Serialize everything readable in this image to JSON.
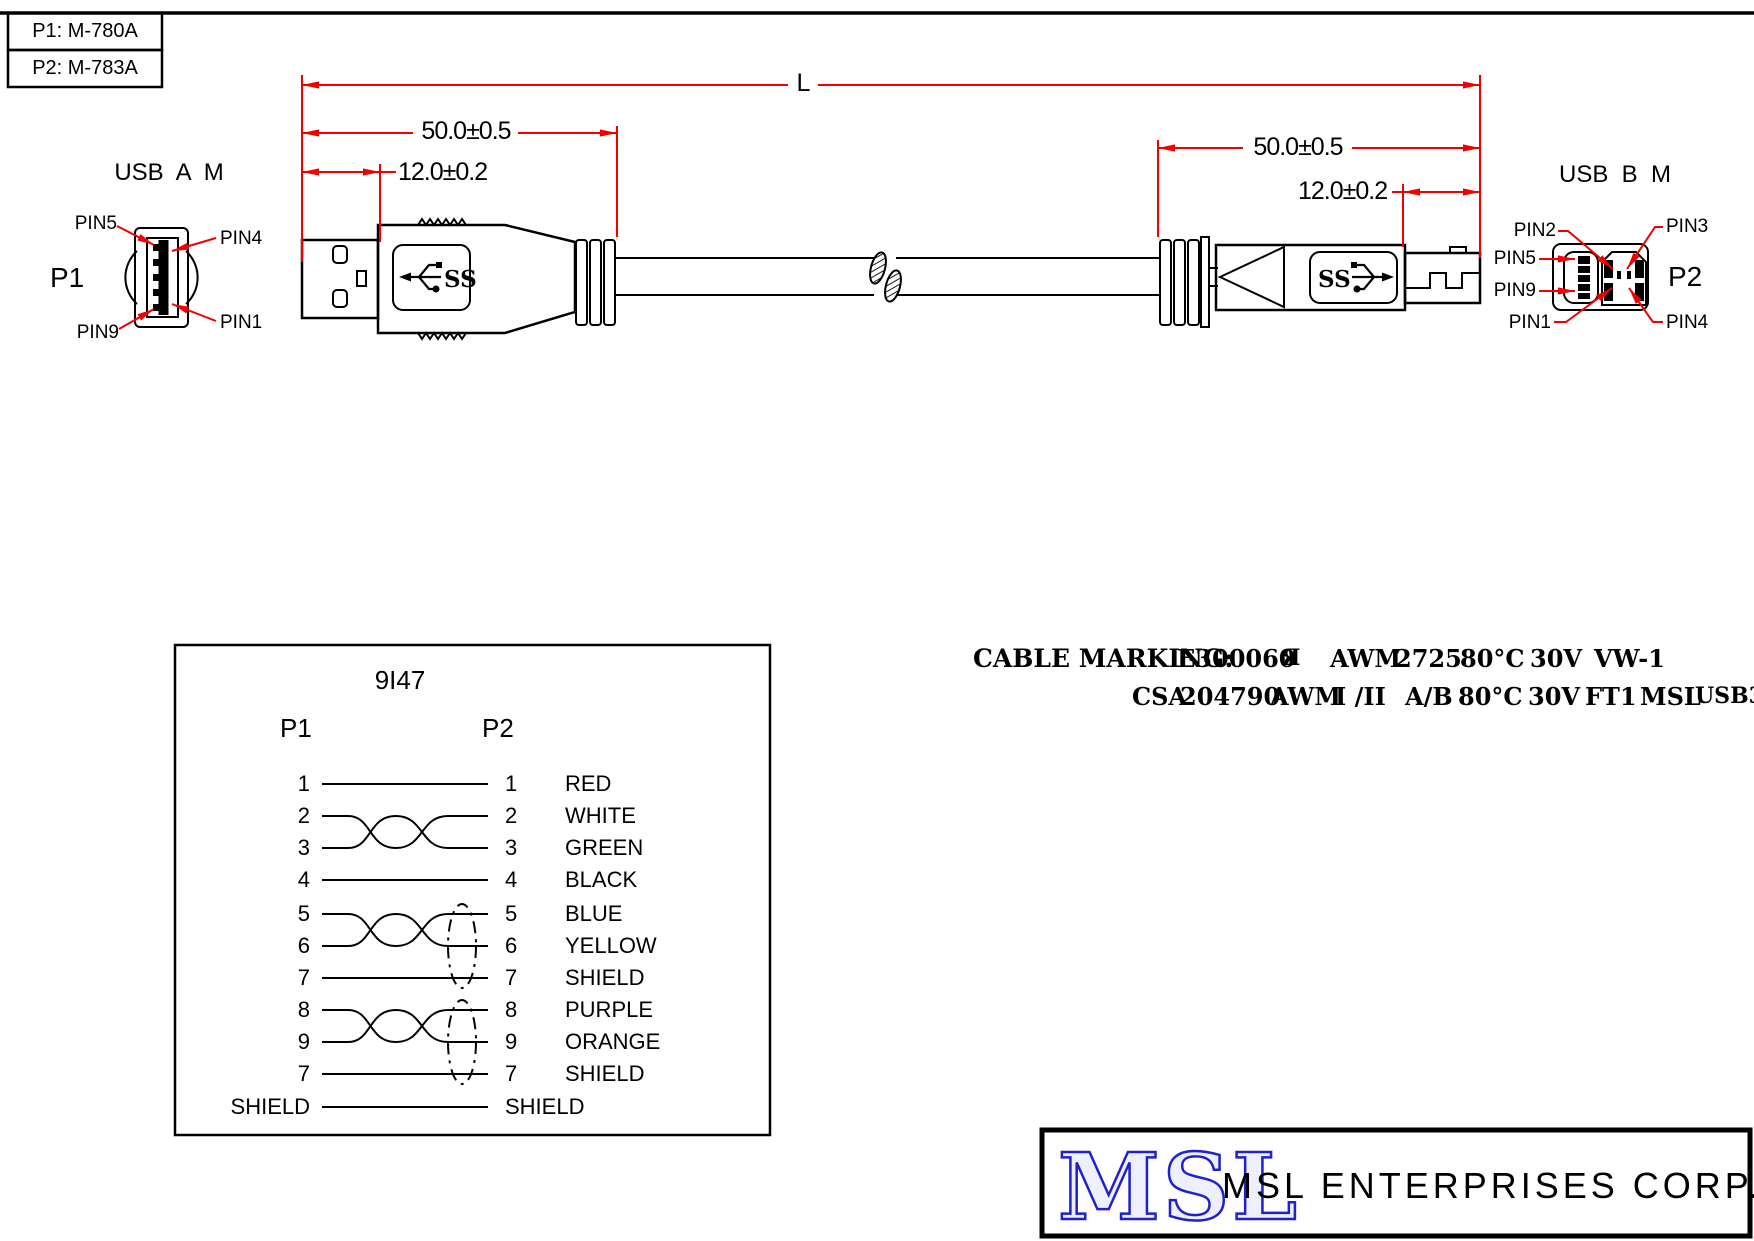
{
  "title_block": {
    "line1": "P1: M-780A",
    "line2": "P2: M-783A"
  },
  "dims": {
    "overall": "L",
    "left_50": "50.0±0.5",
    "left_12": "12.0±0.2",
    "right_50": "50.0±0.5",
    "right_12": "12.0±0.2"
  },
  "connector_a": {
    "title": "USB  A  M",
    "ref": "P1",
    "pin_top_left": "PIN5",
    "pin_top_right": "PIN4",
    "pin_bottom_left": "PIN9",
    "pin_bottom_right": "PIN1"
  },
  "connector_b": {
    "title": "USB  B  M",
    "ref": "P2",
    "pin_top_left": "PIN2",
    "pin_top_right": "PIN3",
    "pin_mid_left_upper": "PIN5",
    "pin_mid_left_lower": "PIN9",
    "pin_bottom_left": "PIN1",
    "pin_bottom_right": "PIN4"
  },
  "drawing": {
    "usb_logo": "SS"
  },
  "wiring": {
    "part_number": "9I47",
    "left_header": "P1",
    "right_header": "P2",
    "rows": [
      {
        "p1": "1",
        "p2": "1",
        "color": "RED"
      },
      {
        "p1": "2",
        "p2": "2",
        "color": "WHITE"
      },
      {
        "p1": "3",
        "p2": "3",
        "color": "GREEN"
      },
      {
        "p1": "4",
        "p2": "4",
        "color": "BLACK"
      },
      {
        "p1": "5",
        "p2": "5",
        "color": "BLUE"
      },
      {
        "p1": "6",
        "p2": "6",
        "color": "YELLOW"
      },
      {
        "p1": "7",
        "p2": "7",
        "color": "SHIELD"
      },
      {
        "p1": "8",
        "p2": "8",
        "color": "PURPLE"
      },
      {
        "p1": "9",
        "p2": "9",
        "color": "ORANGE"
      },
      {
        "p1": "7",
        "p2": "7",
        "color": "SHIELD"
      },
      {
        "p1": "SHIELD",
        "p2": "SHIELD",
        "color": ""
      }
    ]
  },
  "cable_marking": {
    "label": "CABLE MARKING:",
    "ul_file": "E300060",
    "ul_mark": "Я",
    "line1_awm": "AWM",
    "line1_style": "2725",
    "line1_temp": "80°C",
    "line1_volt": "30V",
    "line1_flame": "VW-1",
    "csa": "CSA",
    "csa_number": "204790",
    "line2_awm": "AWM",
    "line2_class": "I /II",
    "line2_ab": "A/B",
    "line2_temp": "80°C",
    "line2_volt": "30V",
    "line2_flame": "FT1",
    "line2_msl": "MSL",
    "line2_usb": "USB3.0"
  },
  "footer": {
    "logo": "MSL",
    "company": "MSL ENTERPRISES CORP."
  },
  "colors": {
    "dimension_red": "#f20000",
    "logo_blue": "#2020cc"
  }
}
